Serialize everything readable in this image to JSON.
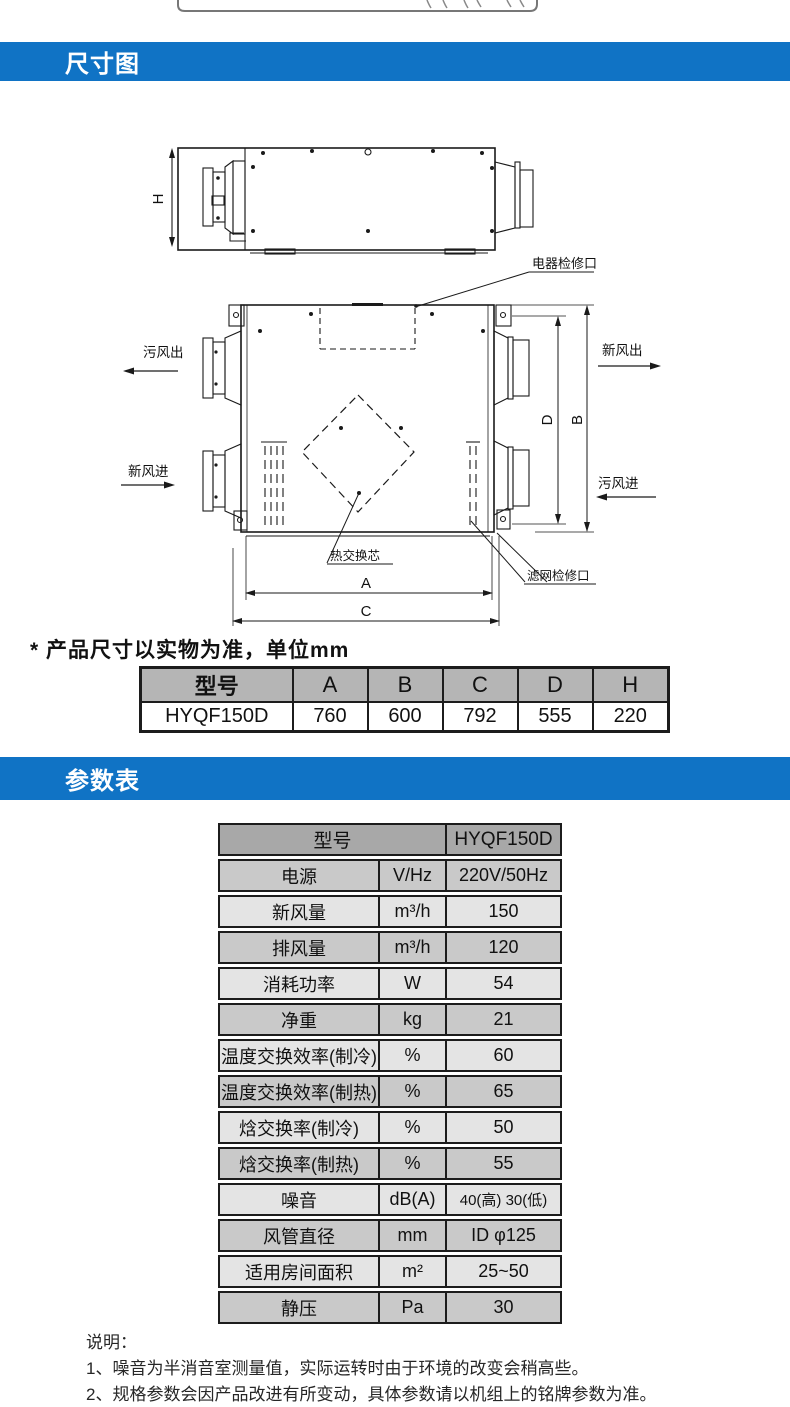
{
  "page": {
    "accent_blue": "#1073c5"
  },
  "section_dimensions": {
    "header": "尺寸图",
    "note": "* 产品尺寸以实物为准，单位mm",
    "labels": {
      "electric_access": "电器检修口",
      "foul_air_out": "污风出",
      "fresh_air_out": "新风出",
      "fresh_air_in": "新风进",
      "foul_air_in": "污风进",
      "heat_core": "热交换芯",
      "filter_access": "滤网检修口",
      "dim_h": "H",
      "dim_a": "A",
      "dim_b": "B",
      "dim_c": "C",
      "dim_d": "D"
    },
    "table": {
      "headers": [
        "型号",
        "A",
        "B",
        "C",
        "D",
        "H"
      ],
      "row": [
        "HYQF150D",
        "760",
        "600",
        "792",
        "555",
        "220"
      ]
    }
  },
  "section_params": {
    "header": "参数表",
    "table": {
      "model_label": "型号",
      "model_value": "HYQF150D",
      "rows": [
        {
          "label": "电源",
          "unit": "V/Hz",
          "value": "220V/50Hz"
        },
        {
          "label": "新风量",
          "unit": "m³/h",
          "value": "150"
        },
        {
          "label": "排风量",
          "unit": "m³/h",
          "value": "120"
        },
        {
          "label": "消耗功率",
          "unit": "W",
          "value": "54"
        },
        {
          "label": "净重",
          "unit": "kg",
          "value": "21"
        },
        {
          "label": "温度交换效率(制冷)",
          "unit": "%",
          "value": "60"
        },
        {
          "label": "温度交换效率(制热)",
          "unit": "%",
          "value": "65"
        },
        {
          "label": "焓交换率(制冷)",
          "unit": "%",
          "value": "50"
        },
        {
          "label": "焓交换率(制热)",
          "unit": "%",
          "value": "55"
        },
        {
          "label": "噪音",
          "unit": "dB(A)",
          "value": "40(高) 30(低)"
        },
        {
          "label": "风管直径",
          "unit": "mm",
          "value": "ID φ125"
        },
        {
          "label": "适用房间面积",
          "unit": "m²",
          "value": "25~50"
        },
        {
          "label": "静压",
          "unit": "Pa",
          "value": "30"
        }
      ]
    }
  },
  "footer": {
    "title": "说明：",
    "note1": "1、噪音为半消音室测量值，实际运转时由于环境的改变会稍高些。",
    "note2": "2、规格参数会因产品改进有所变动，具体参数请以机组上的铭牌参数为准。"
  }
}
